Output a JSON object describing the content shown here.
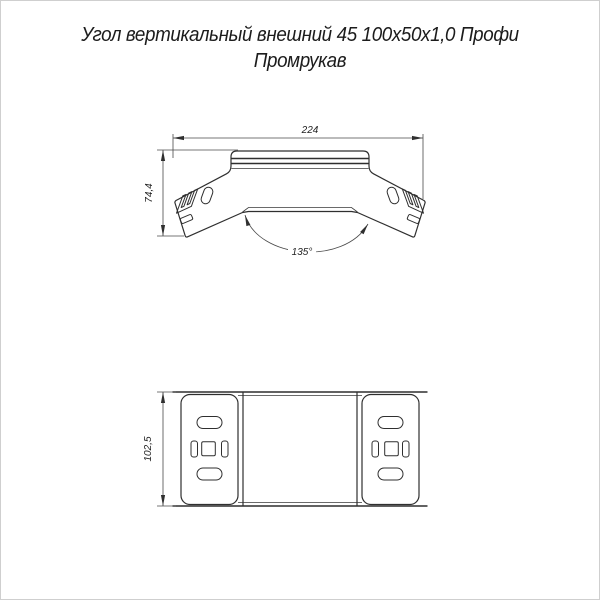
{
  "title": {
    "line1": "Угол вертикальный внешний 45 100х50х1,0 Профи",
    "line2": "Промрукав"
  },
  "drawing": {
    "stroke_color": "#2f2f2f",
    "top_view": {
      "width_dim": "224",
      "height_dim": "74,4",
      "angle_dim": "135°"
    },
    "bottom_view": {
      "height_dim": "102,5"
    }
  }
}
